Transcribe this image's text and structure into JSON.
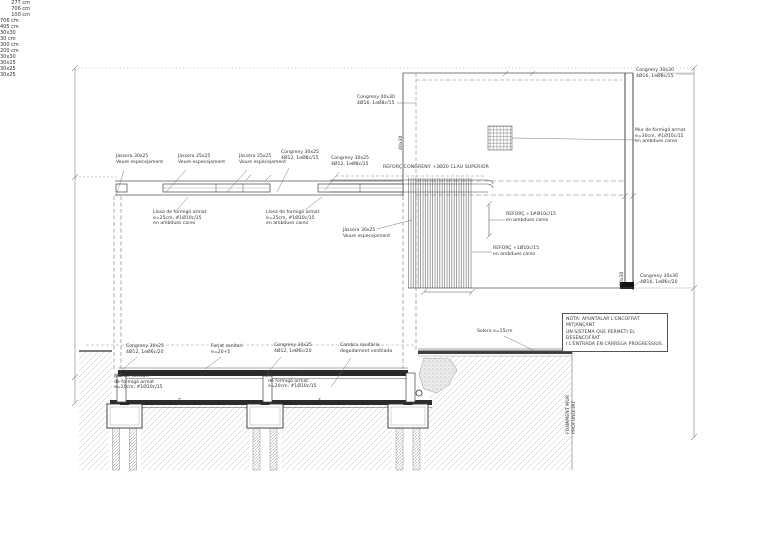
{
  "drawing_type": "structural section drawing",
  "colors": {
    "ink": "#333333",
    "heavy_line": "#2b2b2b",
    "earth_hatch": "#b8b8b8",
    "background": "#ffffff"
  },
  "labels": {
    "dim_277": "277 cm",
    "dim_706_left": "706 cm",
    "dim_100": "100 cm",
    "dim_706_right": "706 cm",
    "dim_405": "405 cm",
    "dim_30x30_top": "30x30",
    "dim_30_cm": "30 cm",
    "dim_300_cm": "300 cm",
    "dim_200_cm": "200 cm",
    "dim_30x30_bottom": "30x30",
    "dim_30x25_top": "30x25",
    "dim_30x25_left": "30x25",
    "dim_30x25_mid": "30x25",
    "dim_40x30_vert": "40x30",
    "dim_30x30_vert": "30x30",
    "fonament_vert": "FONAMENT MUR\nPROFUNDITAT",
    "jassera_1": "Jàssera 30x25\nVeure especejament",
    "jassera_2": "Jàssera 25x25\nVeure especejament",
    "jassera_3": "Jàssera 25x25\nVeure especejament",
    "congreny_1": "Congreny 30x25\n4Ø12, 1eØ8c/15",
    "congreny_2": "Congreny 30x25\n4Ø12, 1eØ8c/15",
    "reforc_congreny": "REFORÇ CONGRENY +3Ø20 CLAU SUPERIOR",
    "congreny_40x30": "Congreny 40x30\n4Ø16, 1eØ8c/15",
    "congreny_30x30_top": "Congreny 30x30\n4Ø16, 1eØ8c/15",
    "mur_formigo": "Mur de formigó armat\ne=30cm, #1Ø10c/15\nen ambdues cares",
    "reforc_1": "REFORÇ +1#Ø10c/15\nen ambdues cares",
    "reforc_2": "REFORÇ +1Ø10c/15\nen ambdues cares",
    "congreny_30x30_bottom": "Congreny 30x30\n4Ø16, 1eØ6c/20",
    "llosa_1": "Llosa de formigó armat\ne=25cm, #1Ø10c/15\nen ambdues cares",
    "llosa_2": "Llosa de formigó armat\ne=25cm, #1Ø10c/15\nen ambdues cares",
    "jassera_4": "Jàssera 30x25\nVeure especejament",
    "congreny_b1": "Congreny 30x25\n4Ø12, 1eØ6c/20",
    "forjat": "Forjat sanitari\ne=20+5",
    "congreny_b2": "Congreny 30x25\n4Ø12, 1eØ6c/20",
    "cambra": "Cambra sanitària\ndegudament ventilada",
    "mur_sanitari_1": "Mur de sanitari\nde formigó armat\ne=20cm, #1Ø10c/15",
    "mur_sanitari_2": "Mur de sanitari\nde formigó armat\ne=20cm, #1Ø10c/15",
    "solera": "Solera e=15cm",
    "t_left": "T",
    "t_right": "T"
  },
  "note": "NOTA: APUNTALAR L'ENCOFRAT MITJANÇANT\nUN SISTEMA QUE PERMETI EL DESENCOFRAT\nI L'ENTRADA EN CÀRREGA PROGRESSIUS."
}
